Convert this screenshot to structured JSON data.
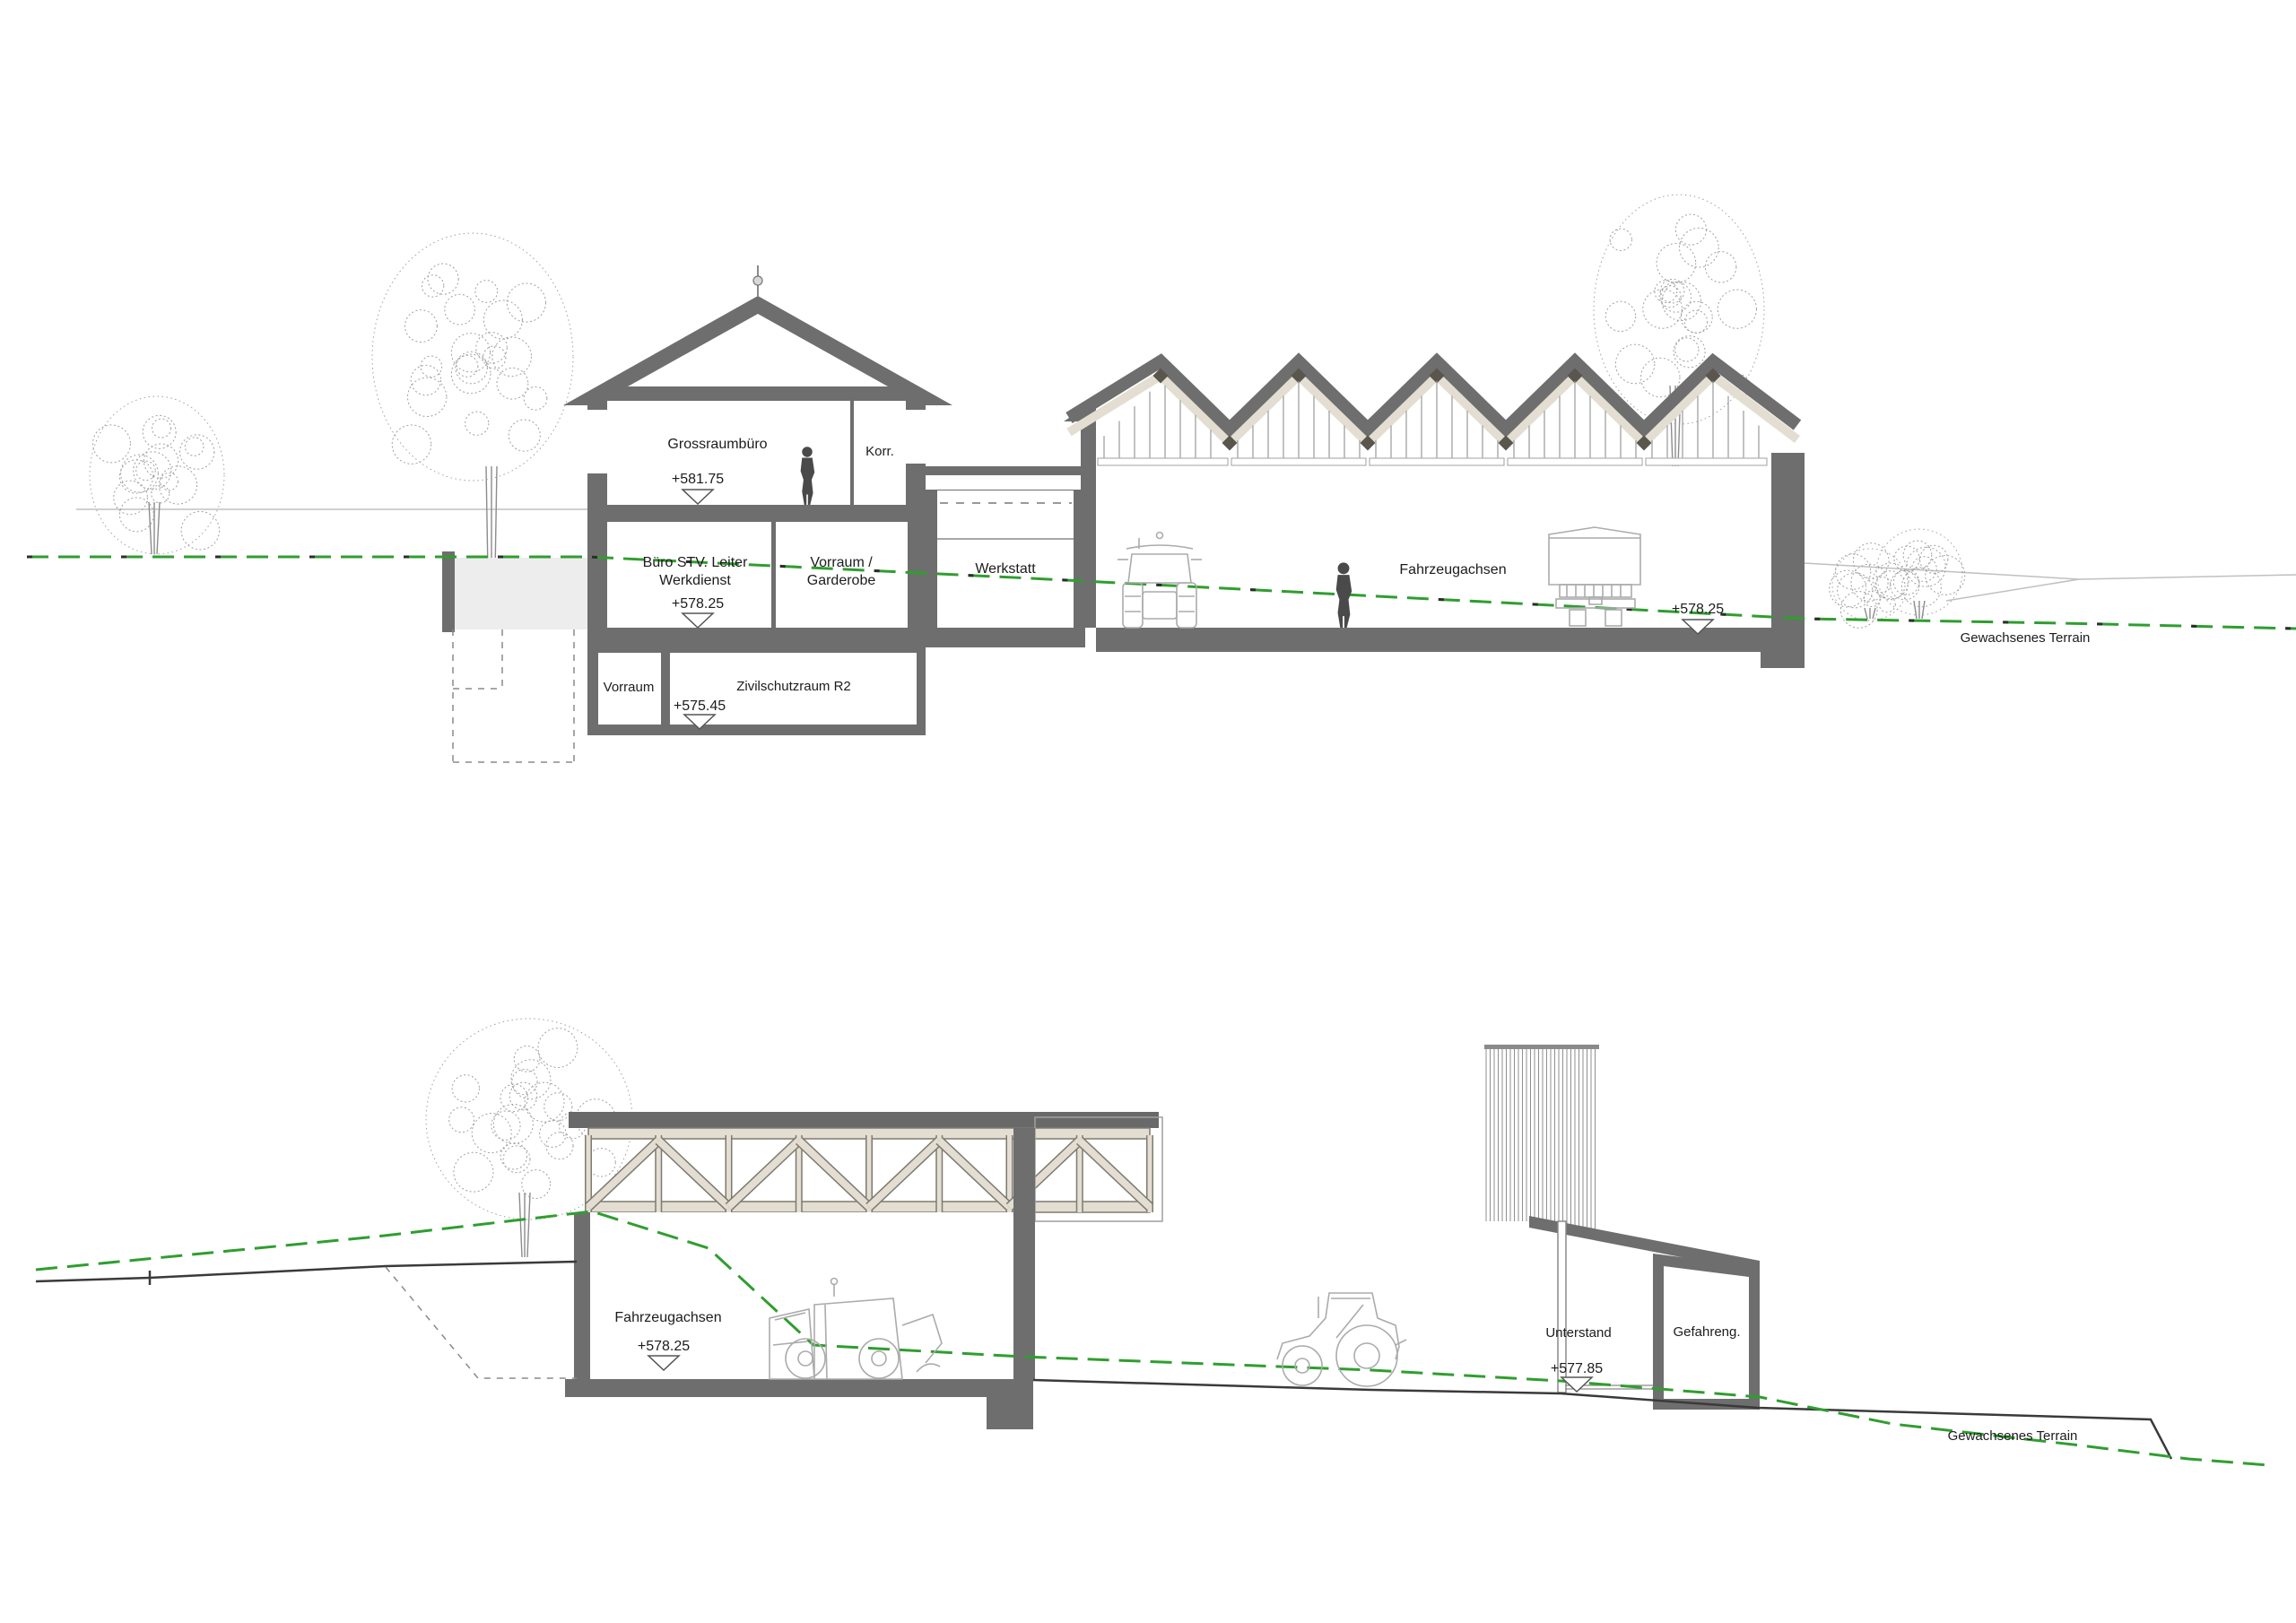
{
  "drawing": {
    "kind": "architectural-section",
    "terrain_label": "Gewachsenes Terrain"
  },
  "colors": {
    "wall": "#6e6e6e",
    "wall_dark": "#5a564e",
    "beige": "#e3ded1",
    "beige_outline": "#7d7a70",
    "pit_fill": "#ededed",
    "terrain_green": "#2f9e2f",
    "terrain_black": "#3a3a3a",
    "sketch": "#a0a0a0",
    "glazing": "#9a9a9a",
    "thin_line": "#b5b5b5",
    "text": "#1c1c1c"
  },
  "top": {
    "rooms": {
      "grossraumbuero": {
        "label": "Grossraumbüro",
        "elevation": "+581.75"
      },
      "korr": {
        "label": "Korr."
      },
      "buero_stv": {
        "label_line1": "Büro STV. Leiter",
        "label_line2": "Werkdienst",
        "elevation": "+578.25"
      },
      "vorraum_garderobe": {
        "label_line1": "Vorraum /",
        "label_line2": "Garderobe"
      },
      "werkstatt": {
        "label": "Werkstatt"
      },
      "vorraum_ug": {
        "label": "Vorraum"
      },
      "zivilschutzraum": {
        "label": "Zivilschutzraum R2",
        "elevation": "+575.45"
      },
      "halle": {
        "label": "Fahrzeugachsen",
        "elevation": "+578.25"
      }
    },
    "terrain_label": "Gewachsenes Terrain",
    "structure": {
      "sawtooth_peaks": 5
    }
  },
  "bottom": {
    "rooms": {
      "halle": {
        "label": "Fahrzeugachsen",
        "elevation": "+578.25"
      },
      "unterstand": {
        "label": "Unterstand",
        "elevation": "+577.85"
      },
      "gefahrengut": {
        "label": "Gefahreng."
      }
    },
    "terrain_label": "Gewachsenes Terrain",
    "structure": {
      "truss_panels": 8
    }
  }
}
